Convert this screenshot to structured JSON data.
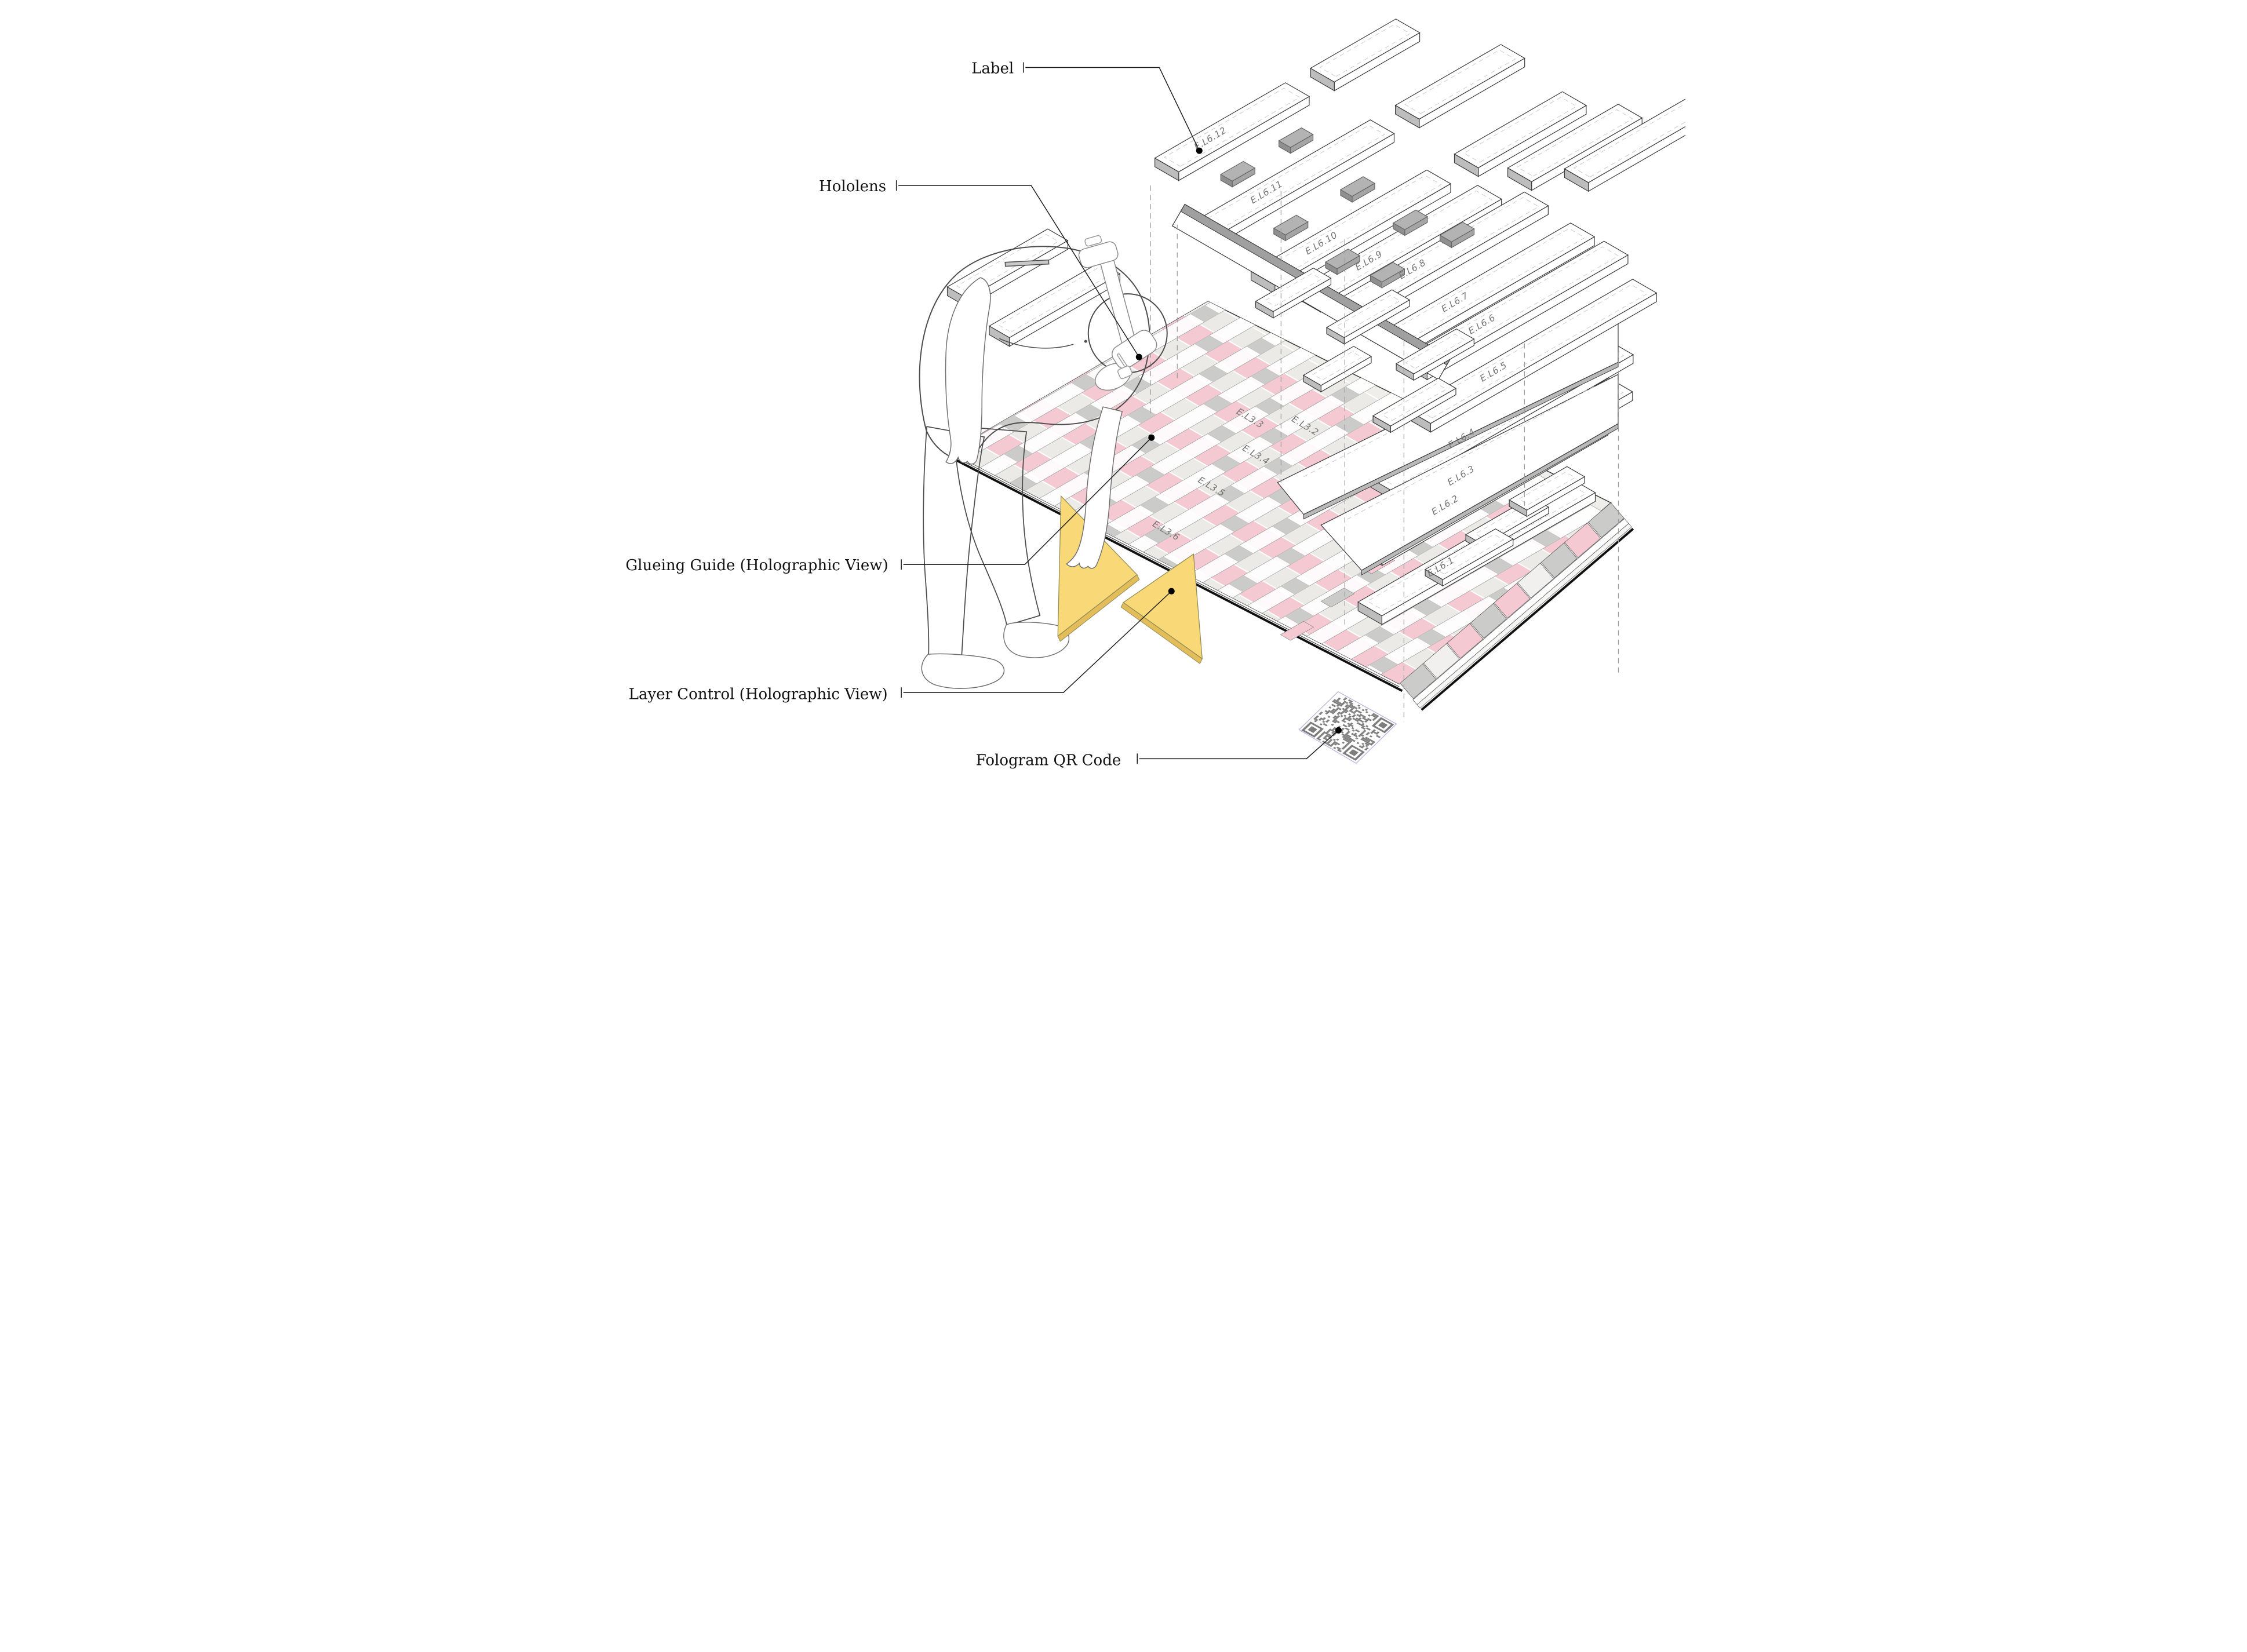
{
  "callouts": {
    "label": {
      "text": "Label"
    },
    "hololens": {
      "text": "Hololens"
    },
    "glueing_guide": {
      "text": "Glueing Guide (Holographic View)"
    },
    "layer_control": {
      "text": "Layer Control (Holographic View)"
    },
    "fologram_qr": {
      "text": "Fologram QR Code"
    }
  },
  "exploded_planks": {
    "labels": [
      "E.L6.12",
      "E.L6.11",
      "E.L6.10",
      "E.L6.9",
      "E.L6.8",
      "E.L6.7",
      "E.L6.6",
      "E.L6.5",
      "E.L6.4",
      "E.L6.3",
      "E.L6.2",
      "E.L6.1"
    ]
  },
  "deck_rows": {
    "labels": [
      "E.L3.3",
      "E.L3.2",
      "E.L3.4",
      "E.L3.5",
      "E.L3.6"
    ]
  },
  "icons": {
    "qr_code": "fologram-qr-code",
    "hologram_triangles": "layer-control-triangle",
    "headset": "hololens-headset"
  },
  "colors": {
    "glue_band_pink": "#f4c9d2",
    "deck_base": "#efeeeb",
    "deck_row_light": "#ebeae7",
    "deck_square_gray": "#cbcbca",
    "hologram_yellow": "#f9d878",
    "hologram_yellow_edge": "#e3bd5a",
    "plank_side_gray": "#bdbdbd",
    "spacer_gray": "#a5a5a5",
    "qr_module_gray": "#7d7d7d",
    "qr_border_lavender": "#b7b1dd",
    "figure_shirt": "#c8c8c8",
    "figure_pants": "#b7b7b7",
    "figure_head": "#bdbdbd",
    "line_black": "#1c1c1c",
    "label_gray": "#757575",
    "outline_dark": "#3a3a3a"
  }
}
